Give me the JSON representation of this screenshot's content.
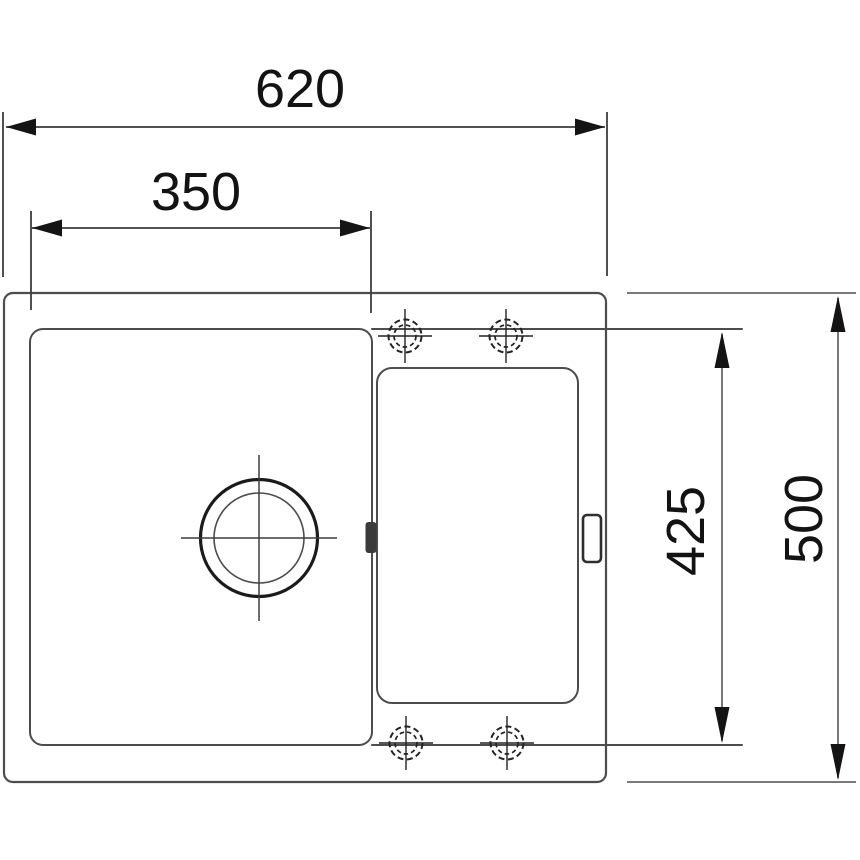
{
  "drawing": {
    "dimension_labels": {
      "overall_width": "620",
      "bowl_width": "350",
      "inner_depth": "425",
      "overall_depth": "500"
    },
    "colors": {
      "background": "#ffffff",
      "outline": "#4d4d4d",
      "drain": "#1b1b1b",
      "crosshair": "#3d3d3d",
      "dim_dark": "#3c3c3c",
      "dim_light": "#7a7a7a",
      "arrow": "#141414",
      "text": "#131313"
    },
    "icons": {
      "drain": "drain-hole-icon",
      "tap_hole": "tap-hole-knockout-icon",
      "overflow": "overflow-notch-icon",
      "rim_clip": "rim-clip-icon"
    }
  }
}
